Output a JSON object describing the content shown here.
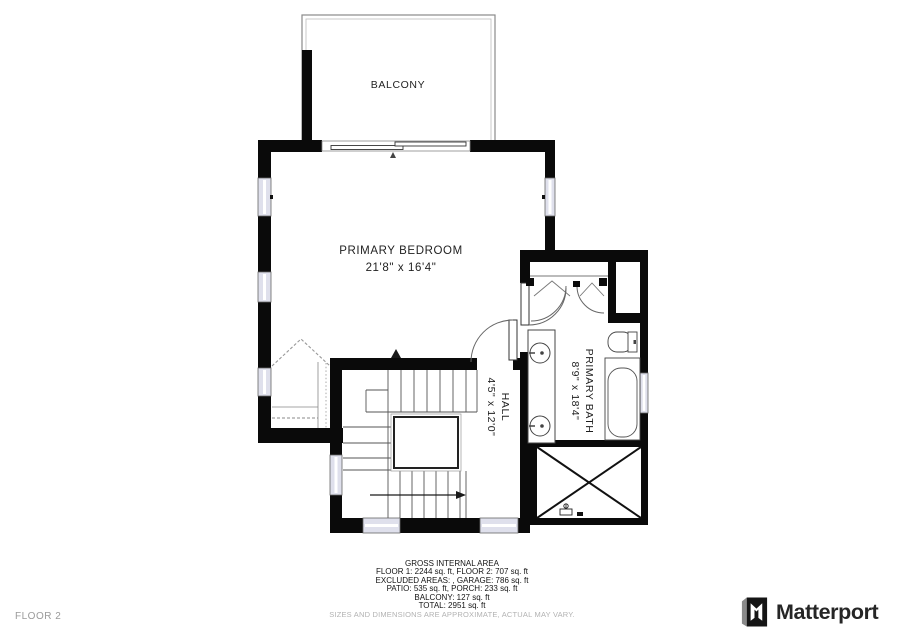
{
  "floor_label": "FLOOR 2",
  "rooms": {
    "balcony": {
      "name": "BALCONY"
    },
    "primary_bedroom": {
      "name": "PRIMARY BEDROOM",
      "dimensions": "21'8\" x 16'4\""
    },
    "primary_bath": {
      "name": "PRIMARY BATH",
      "dimensions": "8'9\" x 18'4\""
    },
    "hall": {
      "name": "HALL",
      "dimensions": "4'5\" x 12'0\""
    }
  },
  "footer": {
    "title": "GROSS INTERNAL AREA",
    "line1": "FLOOR 1: 2244 sq. ft, FLOOR 2: 707 sq. ft",
    "line2": "EXCLUDED AREAS: , GARAGE: 786 sq. ft",
    "line3": "PATIO: 535 sq. ft, PORCH: 233 sq. ft",
    "line4": "BALCONY: 127 sq. ft",
    "line5": "TOTAL: 2951 sq. ft",
    "disclaimer": "SIZES AND DIMENSIONS ARE APPROXIMATE, ACTUAL MAY VARY."
  },
  "brand": {
    "logo_text": "Matterport",
    "logo_icon": "matterport-m-icon"
  },
  "colors": {
    "wall": "#0a0a0a",
    "window_fill": "#dfe0ec",
    "line": "#555555",
    "muted": "#9a9a9a"
  }
}
